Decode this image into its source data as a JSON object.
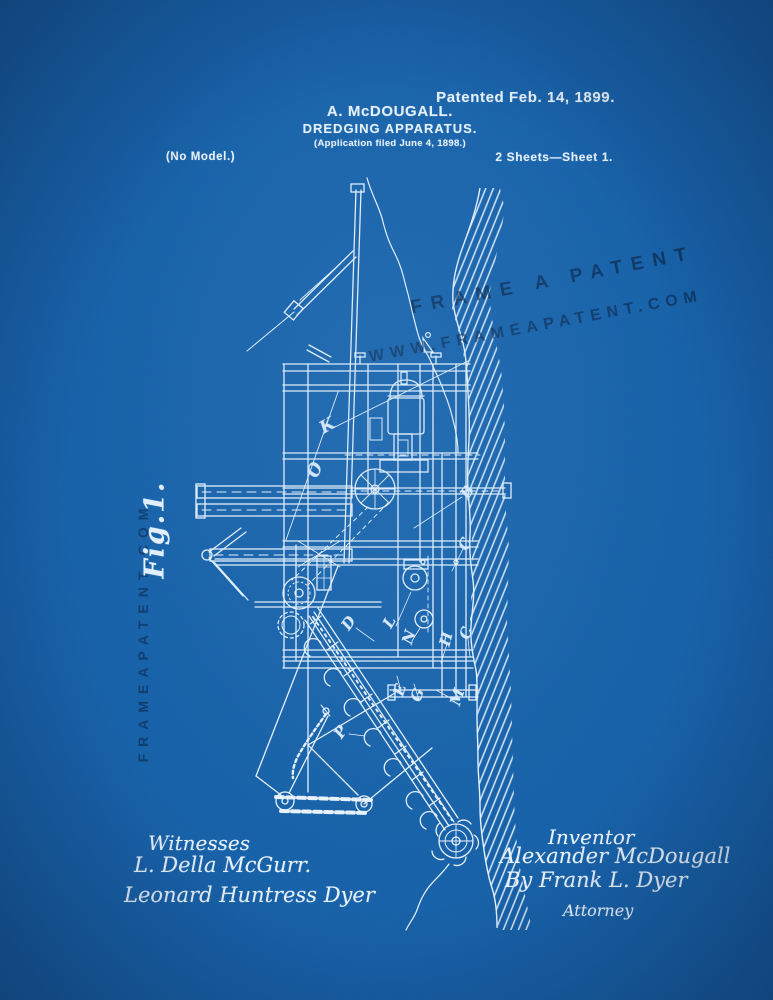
{
  "colors": {
    "background": "#1560a8",
    "ink": "#e8f2fc",
    "watermark": "#0b1f42"
  },
  "header": {
    "patented": "Patented Feb. 14, 1899.",
    "inventor_name": "A. McDOUGALL.",
    "title": "DREDGING APPARATUS.",
    "application": "(Application filed June 4, 1898.)",
    "no_model": "(No Model.)",
    "sheets": "2 Sheets—Sheet 1."
  },
  "watermarks": {
    "diagonal_line1": "FRAME A PATENT",
    "diagonal_line2": "WWW.FRAMEAPATENT.COM",
    "vertical": "FRAMEAPATENT.COM"
  },
  "figure": {
    "label": "Fig.1.",
    "part_labels": [
      "K",
      "O",
      "B",
      "C",
      "D",
      "L",
      "N",
      "H",
      "C",
      "E",
      "G",
      "M",
      "P"
    ]
  },
  "footer": {
    "witnesses_heading": "Witnesses",
    "witness1": "L. Della McGurr.",
    "witness2": "Leonard Huntress Dyer",
    "inventor_heading": "Inventor",
    "inventor_signature": "Alexander McDougall",
    "attorney_signature": "By Frank L. Dyer",
    "attorney_heading": "Attorney"
  }
}
